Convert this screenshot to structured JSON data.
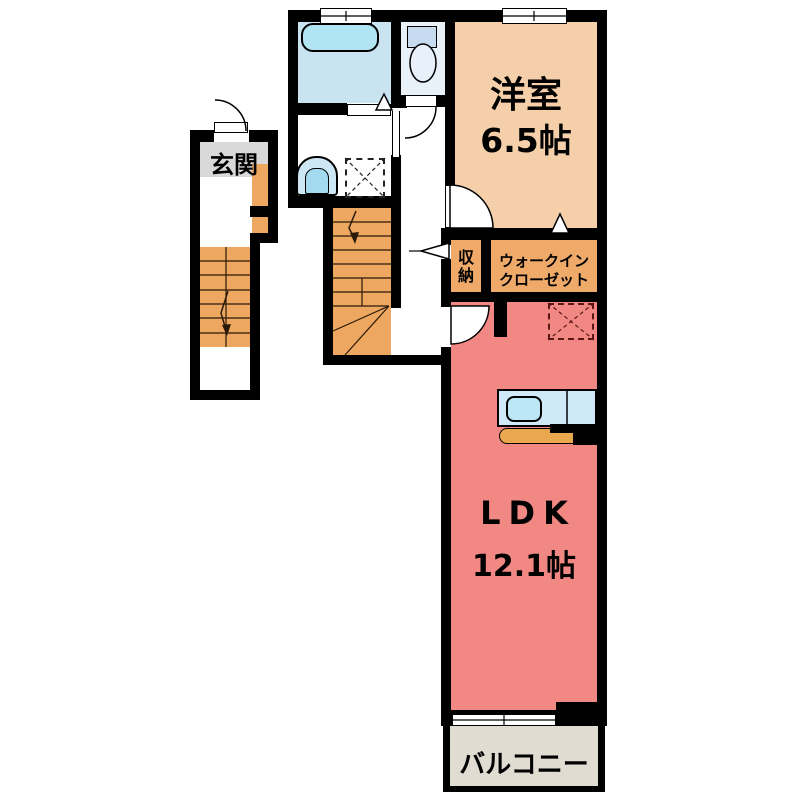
{
  "plan_title": "apartment-floor-plan-2F",
  "rooms": {
    "genkan": {
      "label": "玄関"
    },
    "western": {
      "label": "洋室",
      "size": "6.5帖"
    },
    "storage": {
      "label": "収納"
    },
    "wic": {
      "line1": "ウォークイン",
      "line2": "クローゼット"
    },
    "ldk": {
      "label": "LDK",
      "size": "12.1帖"
    },
    "balcony": {
      "label": "バルコニー"
    }
  },
  "fixtures": [
    "bathtub",
    "toilet",
    "washbasin",
    "washing-machine-pan",
    "staircase-entrance",
    "staircase-middle",
    "refrigerator-space",
    "kitchen-counter",
    "kitchen-sink",
    "kitchen-stove",
    "windows",
    "door-swings"
  ],
  "colors": {
    "wall": "#000000",
    "western_room": "#f4cfaa",
    "closet": "#efa968",
    "ldk": "#f28884",
    "balcony": "#e0dcd2",
    "genkan": "#d9d9d9",
    "stairs": "#eda760",
    "bathroom": "#c9e3f1",
    "bathtub": "#b2e5f3",
    "kitchen_counter": "#cfe9f6",
    "kitchen_front": "#e9a84e"
  }
}
